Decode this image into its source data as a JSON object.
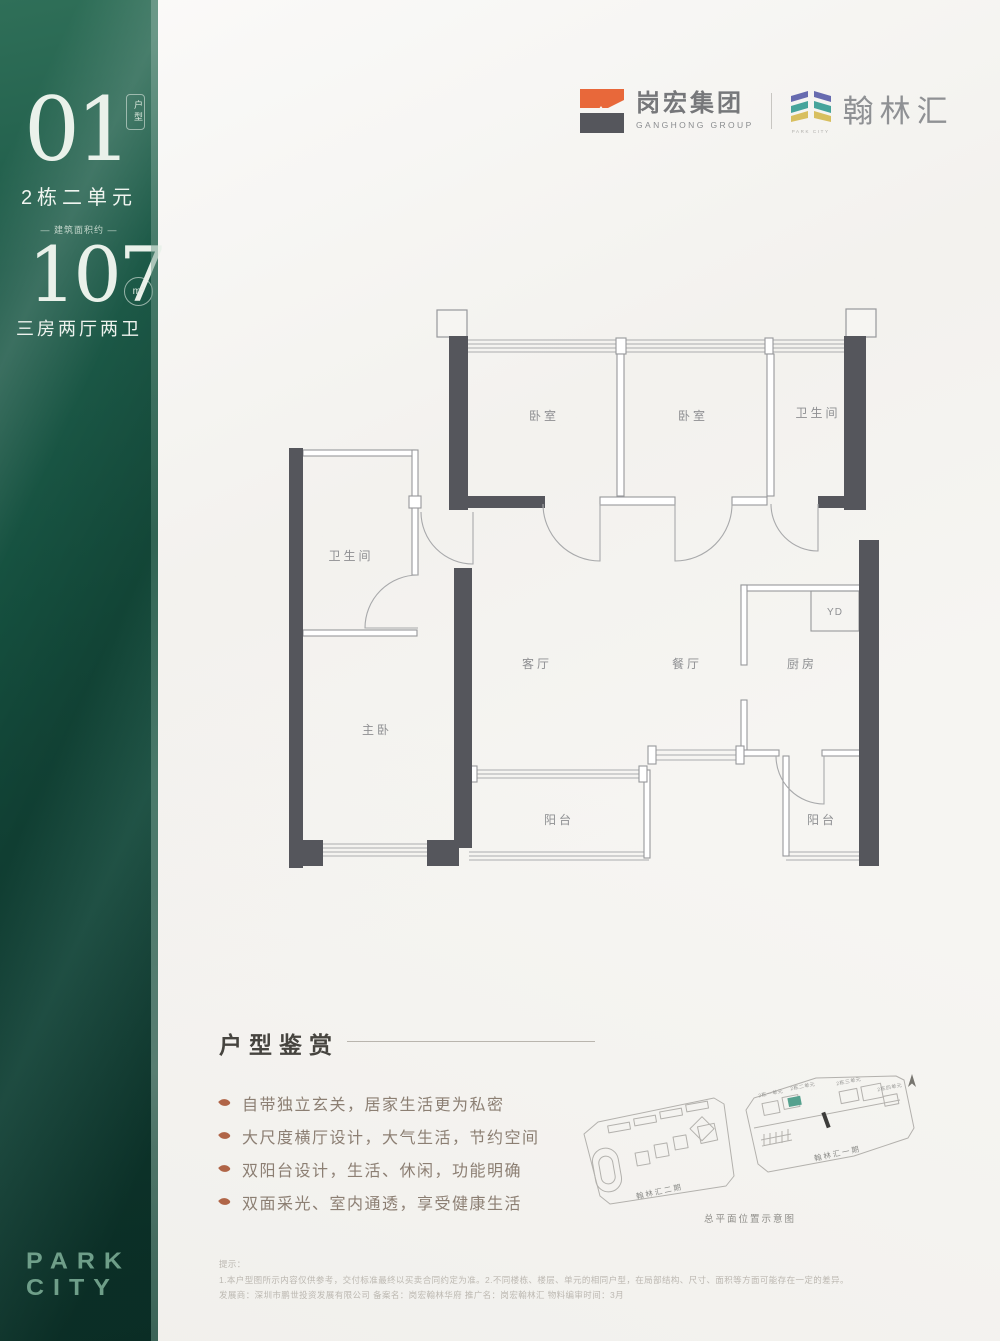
{
  "sidebar": {
    "unit_number": "01",
    "unit_badge": "户型",
    "unit_name": "2栋二单元",
    "area_label": "— 建筑面积约 —",
    "area_value": "107",
    "area_unit": "m²",
    "layout": "三房两厅两卫",
    "brand_line1": "PARK",
    "brand_line2": "CITY",
    "bg_color": "#15503f",
    "text_color": "#eaf1ea"
  },
  "header": {
    "developer_name": "岗宏集团",
    "developer_name_en": "GANGHONG GROUP",
    "project_name": "翰林汇",
    "project_name_en": "PARK CITY",
    "logo_orange": "#e8683a",
    "logo_gray": "#55565c",
    "stripe_purple": "#676bb0",
    "stripe_teal": "#46a49b",
    "stripe_yellow": "#d8bf5f"
  },
  "floorplan": {
    "wall_color": "#55565c",
    "line_color": "#97989b",
    "rooms": [
      {
        "id": "bedroom-1",
        "label": "卧室"
      },
      {
        "id": "bedroom-2",
        "label": "卧室"
      },
      {
        "id": "bathroom-top",
        "label": "卫生间"
      },
      {
        "id": "bathroom-left",
        "label": "卫生间"
      },
      {
        "id": "master-bedroom",
        "label": "主卧"
      },
      {
        "id": "living-room",
        "label": "客厅"
      },
      {
        "id": "dining-room",
        "label": "餐厅"
      },
      {
        "id": "kitchen",
        "label": "厨房"
      },
      {
        "id": "yd",
        "label": "YD"
      },
      {
        "id": "balcony-south",
        "label": "阳台"
      },
      {
        "id": "balcony-east",
        "label": "阳台"
      }
    ]
  },
  "highlights": {
    "title": "户型鉴赏",
    "items": [
      "自带独立玄关，居家生活更为私密",
      "大尺度横厅设计，大气生活，节约空间",
      "双阳台设计，生活、休闲，功能明确",
      "双面采光、室内通透，享受健康生活"
    ],
    "bullet_color": "#b06547"
  },
  "siteplan": {
    "phase1_label": "翰林汇一期",
    "phase2_label": "翰林汇二期",
    "caption": "总平面位置示意图",
    "unit_labels": [
      "2栋一单元",
      "2栋二单元",
      "2栋三单元",
      "2栋四单元"
    ],
    "highlight_color": "#55a18e"
  },
  "footnote": {
    "title": "提示：",
    "line1": "1.本户型图所示内容仅供参考，交付标准最终以买卖合同约定为准。2.不同楼栋、楼层、单元的相同户型，在局部结构、尺寸、面积等方面可能存在一定的差异。",
    "line2": "发展商：深圳市鹏世投资发展有限公司 备案名：岗宏翰林华府 推广名：岗宏翰林汇 物料编审时间：3月"
  }
}
